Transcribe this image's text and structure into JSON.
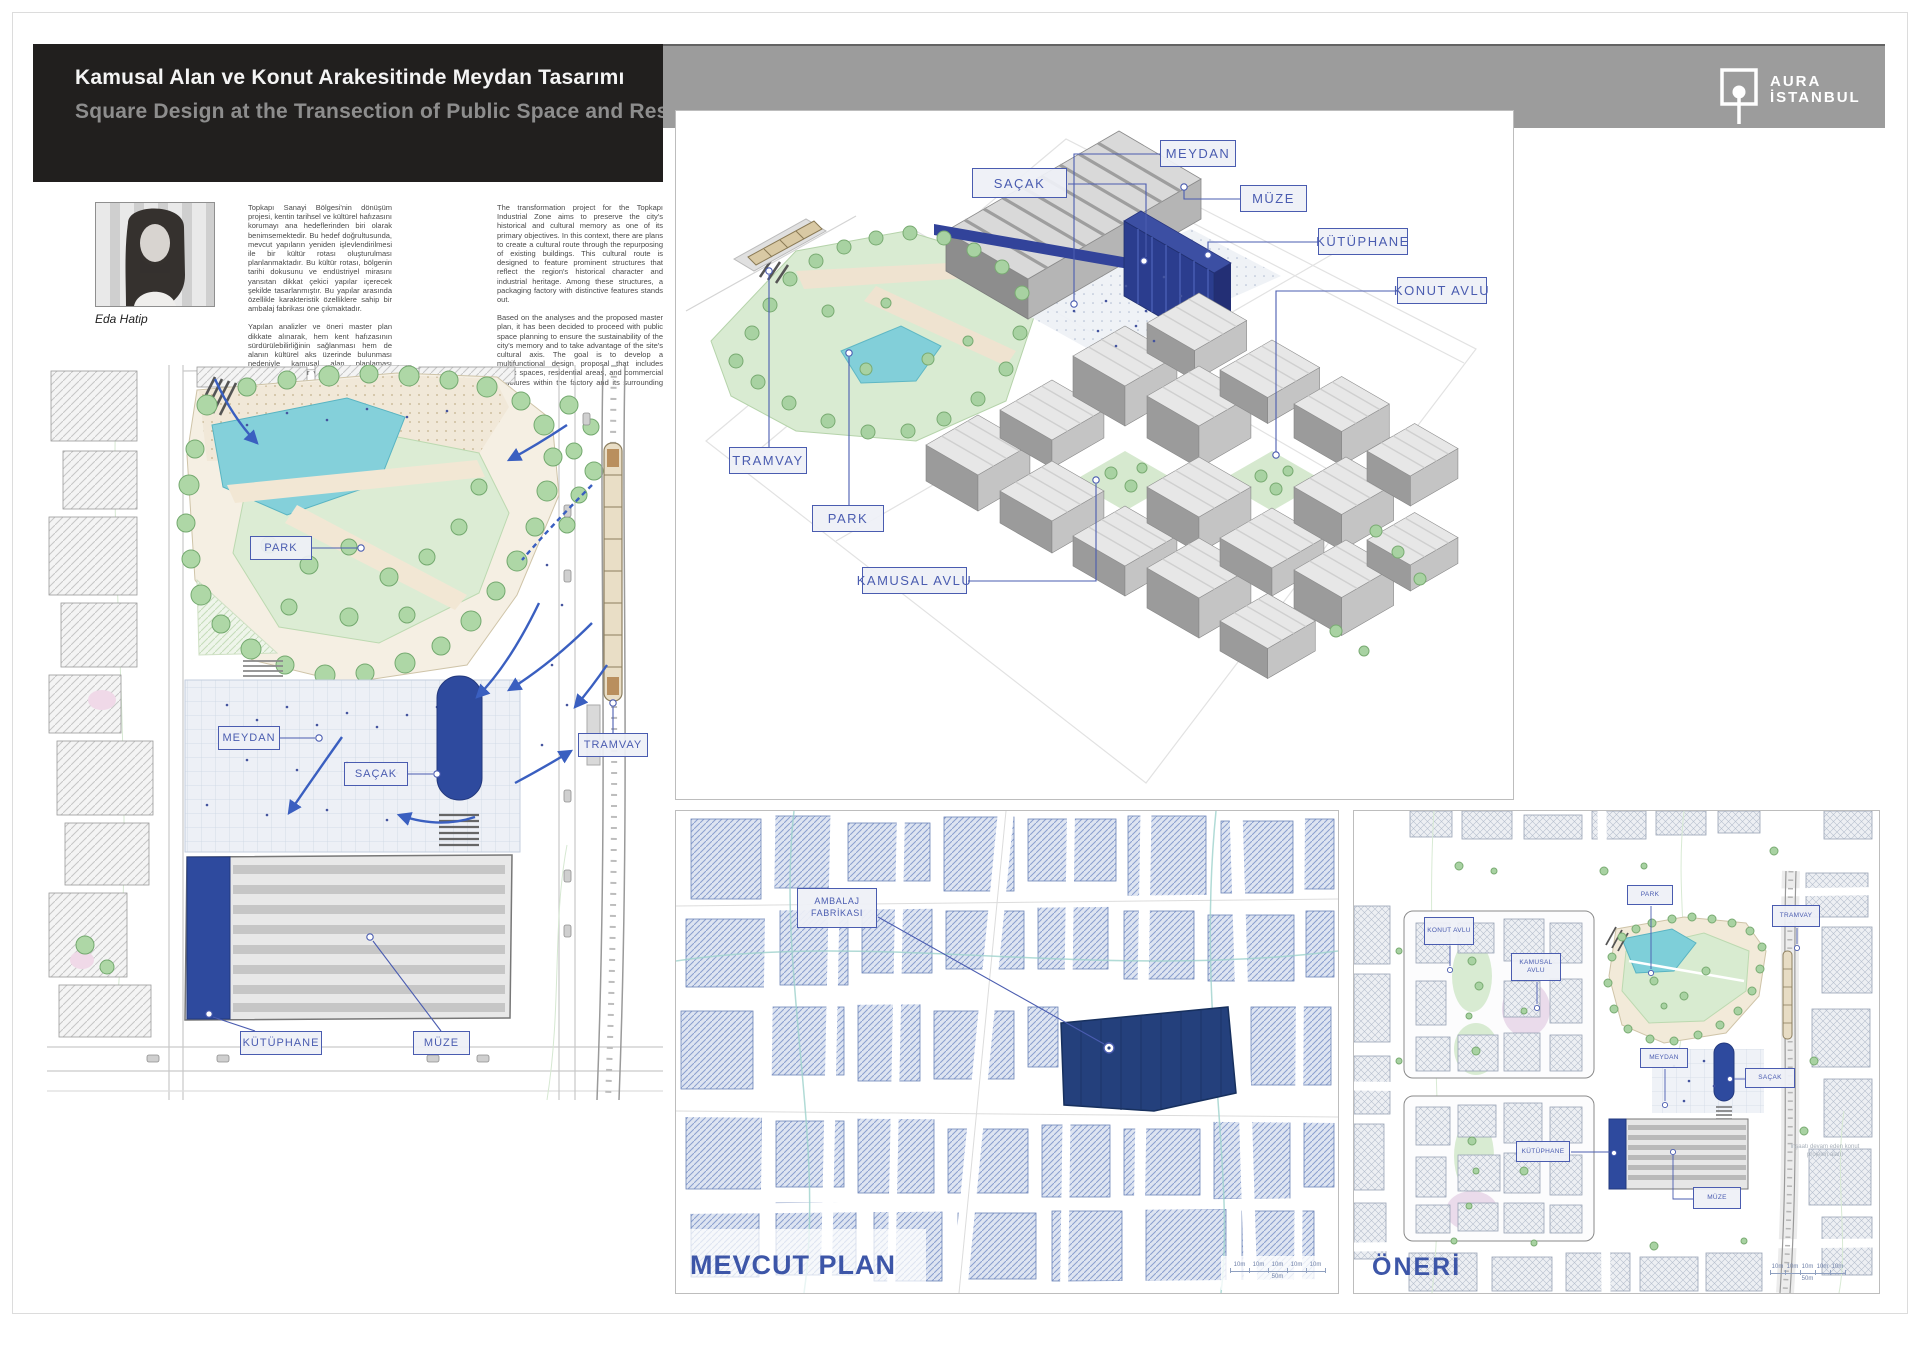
{
  "header": {
    "title_tr": "Kamusal Alan ve Konut Arakesitinde Meydan Tasarımı",
    "title_en": "Square Design at the Transection of Public Space and Residential"
  },
  "brand": {
    "name_line1": "AURA",
    "name_line2": "İSTANBUL"
  },
  "author": {
    "name": "Eda Hatip",
    "bio_tr_p1": "Topkapı Sanayi Bölgesi'nin dönüşüm projesi, kentin tarihsel ve kültürel hafızasını korumayı ana hedeflerinden biri olarak benimsemektedir. Bu hedef doğrultusunda, mevcut yapıların yeniden işlevlendirilmesi ile bir kültür rotası oluşturulması planlanmaktadır. Bu kültür rotası, bölgenin tarihi dokusunu ve endüstriyel mirasını yansıtan dikkat çekici yapılar içerecek şekilde tasarlanmıştır. Bu yapılar arasında özellikle karakteristik özelliklere sahip bir ambalaj fabrikası öne çıkmaktadır.",
    "bio_tr_p2": "Yapılan analizler ve öneri master plan dikkate alınarak, hem kent hafızasının sürdürülebilirliğinin sağlanması hem de alanın kültürel aks üzerinde bulunması nedeniyle kamusal alan planlaması yapılmasına karar verilmiştir. Söz konusu fabrika ve çevresinde kamusal alanlar, konutlar ve ticari yapıları içeren çok işlevli bir tasarım önerisi geliştirilmesi amaçlanmaktadır.",
    "bio_en_p1": "The transformation project for the Topkapı Industrial Zone aims to preserve the city's historical and cultural memory as one of its primary objectives. In this context, there are plans to create a cultural route through the repurposing of existing buildings. This cultural route is designed to feature prominent structures that reflect the region's historical character and industrial heritage. Among these structures, a packaging factory with distinctive features stands out.",
    "bio_en_p2": "Based on the analyses and the proposed master plan, it has been decided to proceed with public space planning to ensure the sustainability of the city's memory and to take advantage of the site's cultural axis. The goal is to develop a multifunctional design proposal that includes public spaces, residential areas, and commercial structures within the factory and its surrounding area."
  },
  "axon": {
    "labels": {
      "sacak": "SAÇAK",
      "meydan": "MEYDAN",
      "muze": "MÜZE",
      "kutuphane": "KÜTÜPHANE",
      "konut_avlu": "KONUT AVLU",
      "tramvay": "TRAMVAY",
      "park": "PARK",
      "kamusal_avlu": "KAMUSAL AVLU"
    }
  },
  "site_plan": {
    "labels": {
      "park": "PARK",
      "meydan": "MEYDAN",
      "sacak": "SAÇAK",
      "tramvay": "TRAMVAY",
      "kutuphane": "KÜTÜPHANE",
      "muze": "MÜZE"
    }
  },
  "mevcut": {
    "title": "MEVCUT PLAN",
    "factory_label": "AMBALAJ FABRİKASI",
    "scale": {
      "segments": [
        "10m",
        "10m",
        "10m",
        "10m",
        "10m"
      ],
      "total": "50m"
    }
  },
  "oneri": {
    "title": "ÖNERİ",
    "labels": {
      "park": "PARK",
      "tramvay": "TRAMVAY",
      "konut_avlu": "KONUT AVLU",
      "kamusal_avlu": "KAMUSAL AVLU",
      "meydan": "MEYDAN",
      "sacak": "SAÇAK",
      "kutuphane": "KÜTÜPHANE",
      "muze": "MÜZE"
    },
    "note": "inşaatı devam eden konut projeleri alanı",
    "scale": {
      "segments": [
        "10m",
        "10m",
        "10m",
        "10m",
        "10m"
      ],
      "total": "50m"
    }
  },
  "colors": {
    "accent_blue": "#3d56a8",
    "building_blue": "#2e4a9e",
    "label_blue": "#4a5cb0"
  }
}
